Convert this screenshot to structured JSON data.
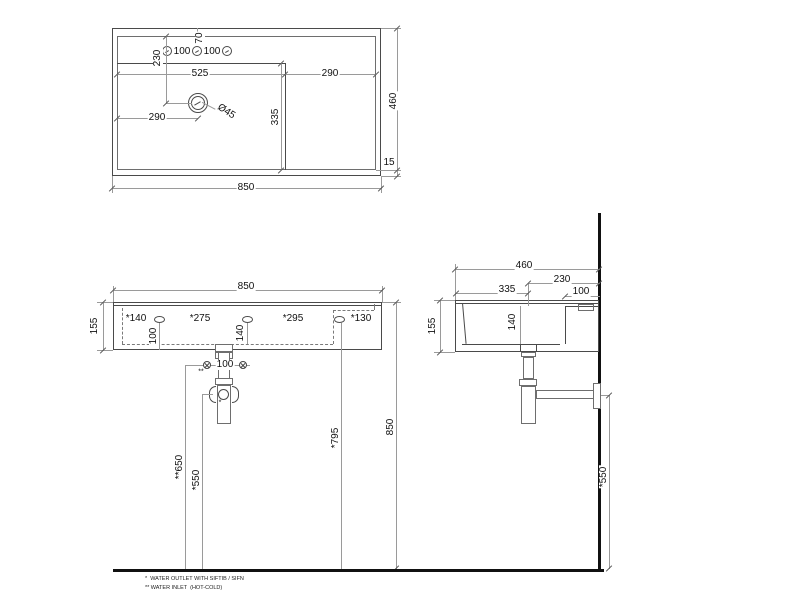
{
  "top": {
    "w": "850",
    "h": "460",
    "rim": "15",
    "bowl_w": "525",
    "deck_w": "290",
    "drain_x": "290",
    "drain_y": "230",
    "bowl_d": "335",
    "drain_dia": "Ø45",
    "sp1": "100",
    "sp2": "100",
    "off": "70"
  },
  "front": {
    "w": "850",
    "total_h": "850",
    "rim_h": "155",
    "h1": "*140",
    "h2": "*275",
    "h3": "*295",
    "h4": "*130",
    "hole_h": "100",
    "drain_h": "140",
    "inlet_sp": "100",
    "inlet_mark": "**",
    "outlet_mark": "*",
    "outlet_h": "*550",
    "inlet_h": "**650",
    "holes_h": "*795"
  },
  "side": {
    "d": "460",
    "d1": "230",
    "d2": "335",
    "d3": "100",
    "rim_h": "155",
    "drain_h": "140",
    "outlet_h": "*550"
  },
  "notes": {
    "n1": "*  WATER OUTLET WITH SIFTIB / SIFN",
    "n2": "** WATER INLET  (HOT-COLD)"
  }
}
